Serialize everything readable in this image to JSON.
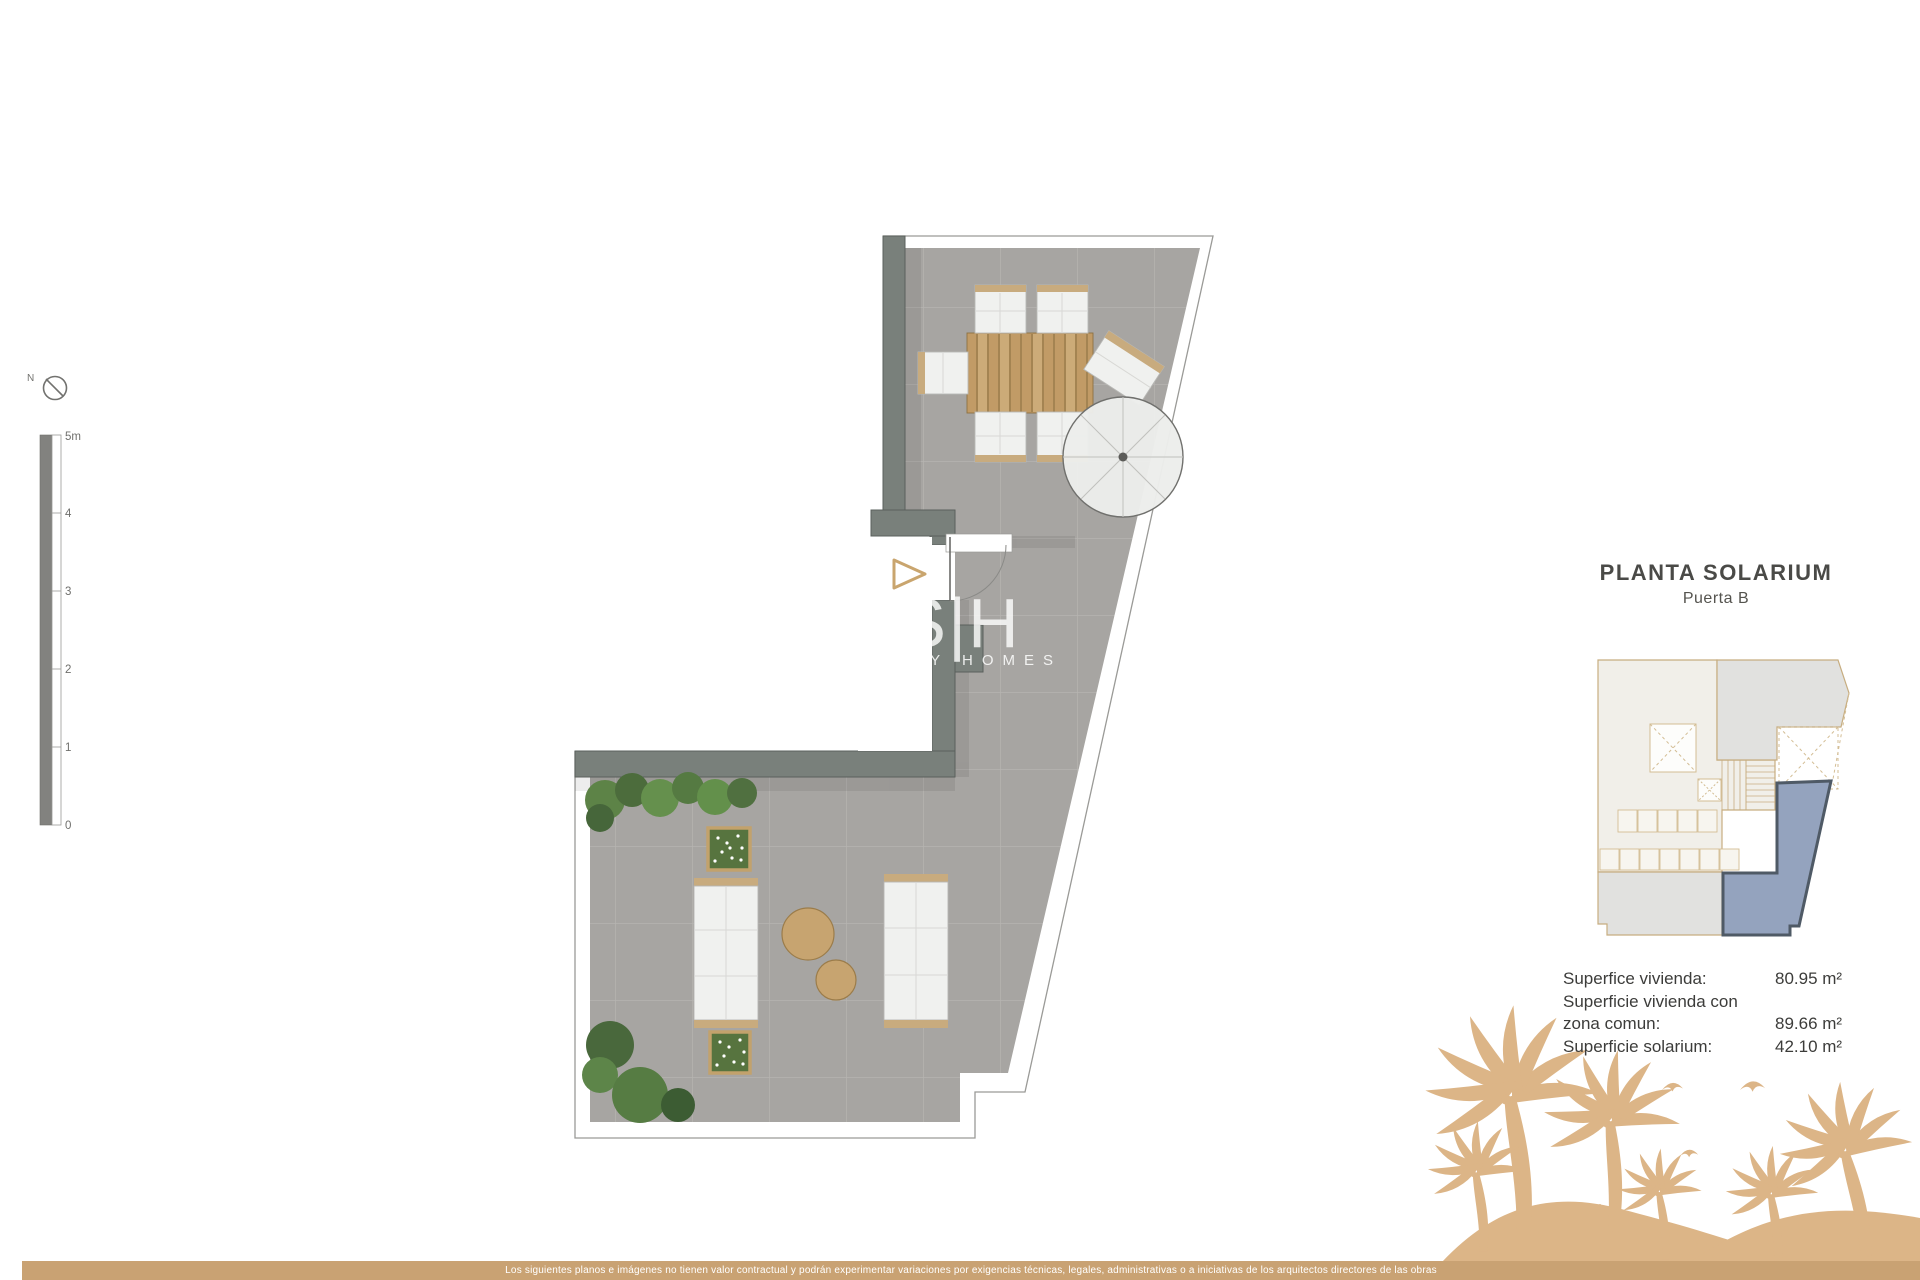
{
  "title": {
    "heading": "PLANTA SOLARIUM",
    "subheading": "Puerta B"
  },
  "areas": {
    "rows": [
      {
        "label": "Superfice vivienda:",
        "value": "80.95 m²"
      },
      {
        "label": "Superficie vivienda con",
        "value": ""
      },
      {
        "label": "zona comun:",
        "value": "89.66 m²"
      },
      {
        "label": "Superficie solarium:",
        "value": "42.10 m²"
      }
    ]
  },
  "scalebar": {
    "labels": [
      "5m",
      "4",
      "3",
      "2",
      "1",
      "0"
    ]
  },
  "compass": {
    "label": "N"
  },
  "watermark": {
    "initials": "S|H",
    "tagline": "ARITY HOMES"
  },
  "disclaimer": {
    "text": "Los siguientes planos e imágenes no tienen valor contractual y podrán experimentar variaciones por exigencias técnicas, legales, administrativas o a iniciativas de los arquitectos directores de las obras"
  },
  "colors": {
    "accent_tan": "#d9b586",
    "bar_tan": "#c9a273",
    "wall_gray": "#79807b",
    "floor_gray": "#a7a5a2",
    "unit_blue": "#94a3be",
    "text_dark": "#4a4a47"
  }
}
